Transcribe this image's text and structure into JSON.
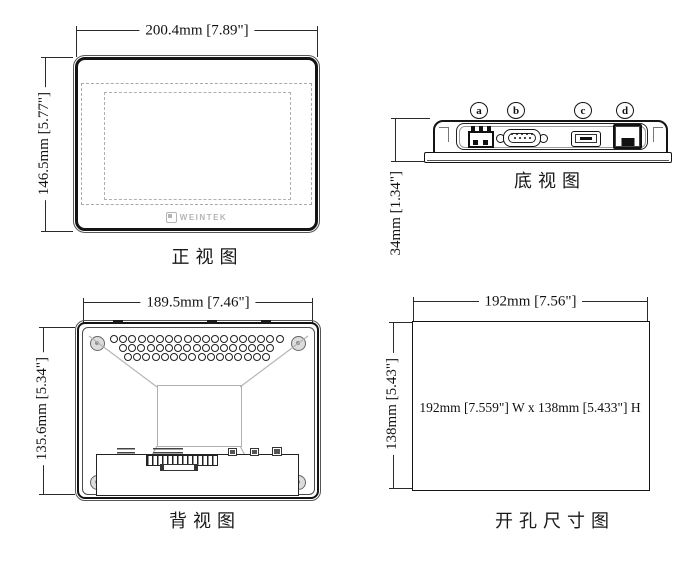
{
  "drawing": {
    "background": "#ffffff",
    "line_color": "#1a1a1a",
    "dashed_color": "#aaaaaa",
    "logo_color": "#b5b5b5"
  },
  "views": {
    "front": {
      "label": "正视图",
      "width_dim": "200.4mm [7.89\"]",
      "height_dim": "146.5mm [5.77\"]",
      "logo_text": "WEINTEK"
    },
    "bottom": {
      "label": "底视图",
      "height_dim": "34mm [1.34\"]",
      "port_labels": [
        "a",
        "b",
        "c",
        "d"
      ],
      "port_names": [
        "power-terminal",
        "serial-db9",
        "usb-port",
        "ethernet-rj45"
      ]
    },
    "back": {
      "label": "背视图",
      "width_dim": "189.5mm [7.46\"]",
      "height_dim": "135.6mm [5.34\"]",
      "vent_rows": [
        19,
        17,
        16
      ]
    },
    "cutout": {
      "label": "开孔尺寸图",
      "width_dim": "192mm [7.56\"]",
      "height_dim": "138mm [5.43\"]",
      "center_text": "192mm [7.559\"] W x 138mm [5.433\"] H"
    }
  }
}
